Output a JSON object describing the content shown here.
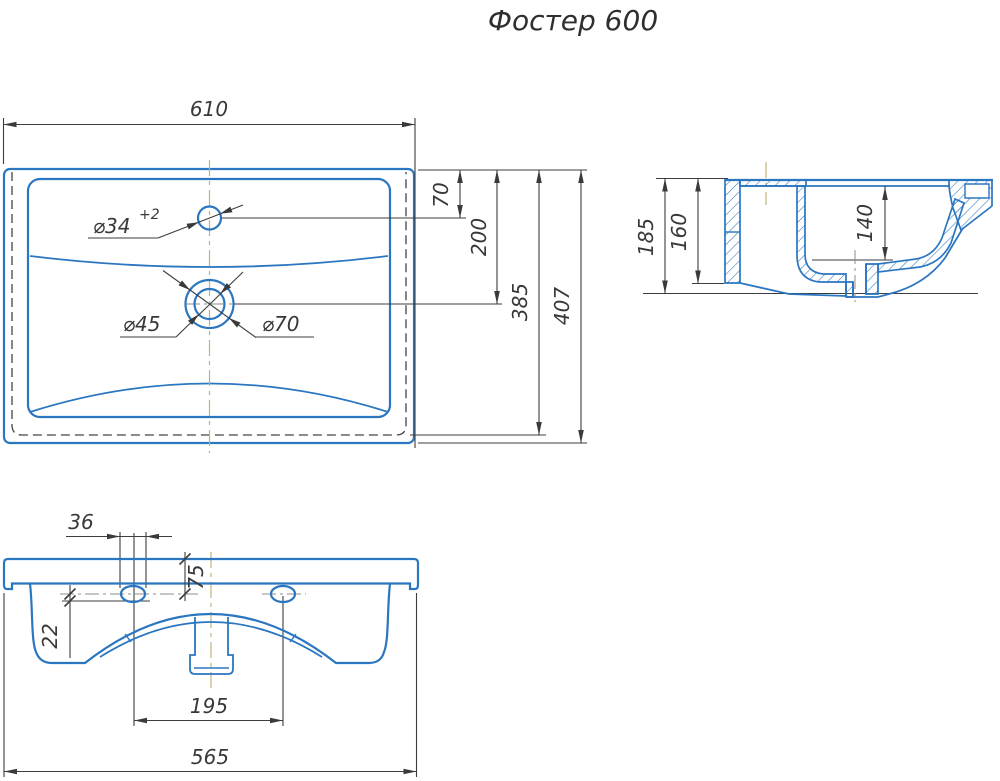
{
  "title": "Фостер 600",
  "colors": {
    "line_blue": "#2b76c0",
    "dim_dark": "#3d3d3d",
    "centerline_olive": "#bfb37a"
  },
  "top_view": {
    "width": "610",
    "hole_offset": "70",
    "drain_offset": "200",
    "inner_length": "385",
    "total_length": "407",
    "faucet_dia": "⌀34",
    "faucet_tol": "+2",
    "drain_dia_inner": "⌀45",
    "drain_dia_outer": "⌀70"
  },
  "side_view": {
    "height_total": "185",
    "height_body": "160",
    "depth_basin": "140"
  },
  "front_view": {
    "hole_width": "36",
    "top_to_hole": "75",
    "hole_drop": "22",
    "hole_spacing": "195",
    "width_bottom": "565"
  }
}
